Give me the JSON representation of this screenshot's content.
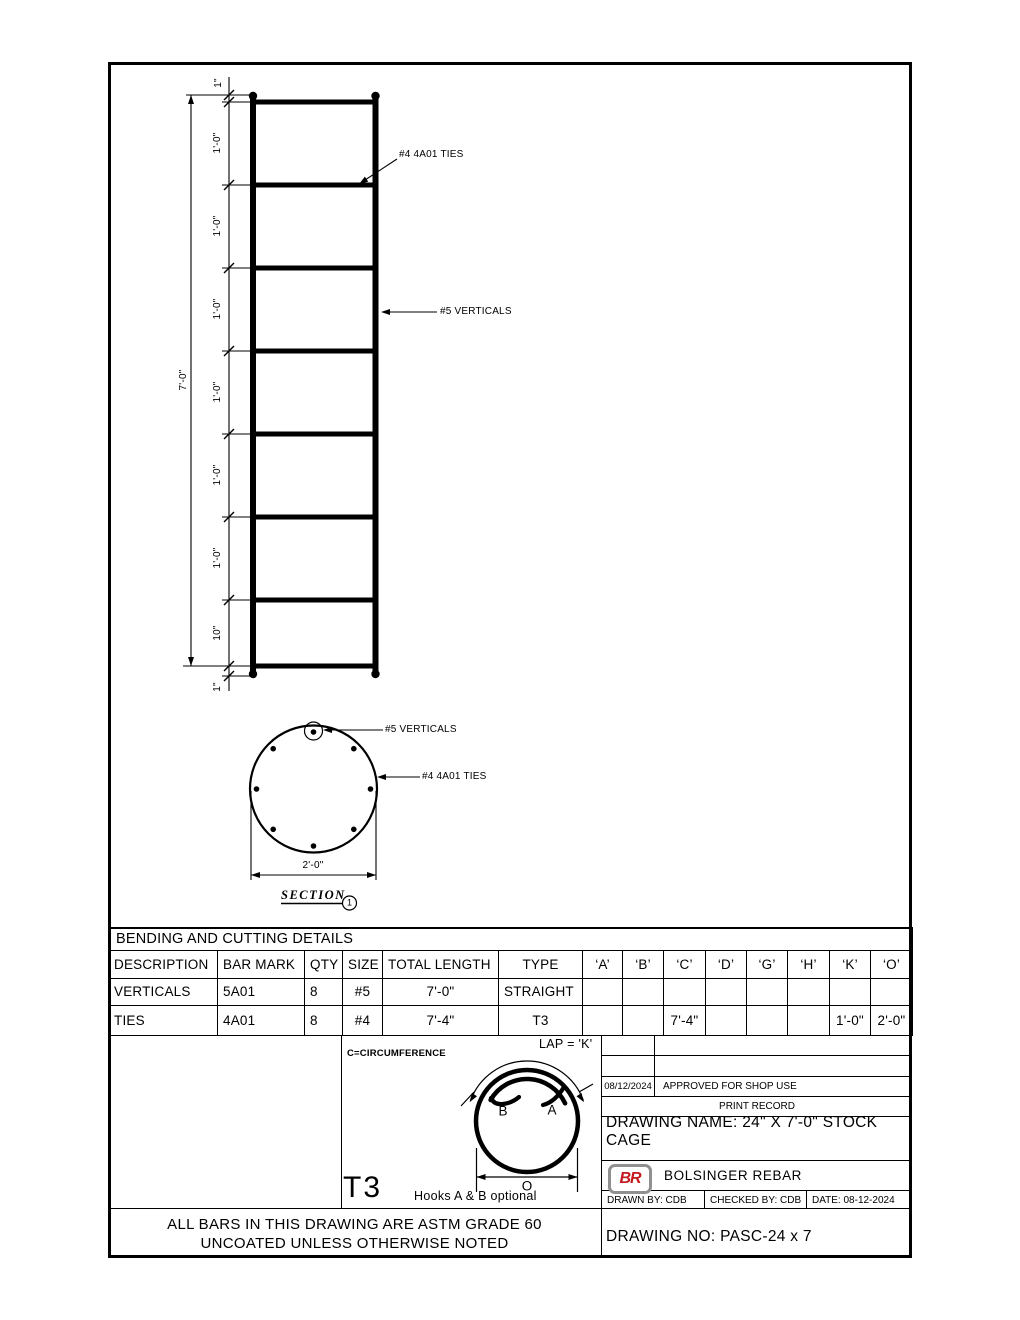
{
  "drawing": {
    "elevation": {
      "overall_dim": "7'-0\"",
      "spacings": [
        "1\"",
        "1'-0\"",
        "1'-0\"",
        "1'-0\"",
        "1'-0\"",
        "1'-0\"",
        "1'-0\"",
        "10\"",
        "1\""
      ],
      "tie_label": "#4 4A01 TIES",
      "vertical_label": "#5 VERTICALS"
    },
    "section": {
      "vertical_label": "#5 VERTICALS",
      "tie_label": "#4 4A01 TIES",
      "diameter_dim": "2'-0\"",
      "title": "SECTION",
      "balloon": "1"
    },
    "t3_detail": {
      "circumference_note": "C=CIRCUMFERENCE",
      "lap_label": "LAP = 'K'",
      "hook_b": "B",
      "hook_a": "A",
      "dim_o": "O",
      "type_label": "T3",
      "hooks_note": "Hooks A & B optional"
    }
  },
  "bending_table": {
    "title": "BENDING AND CUTTING DETAILS",
    "headers": [
      "DESCRIPTION",
      "BAR MARK",
      "QTY",
      "SIZE",
      "TOTAL LENGTH",
      "TYPE",
      "‘A’",
      "‘B’",
      "‘C’",
      "‘D’",
      "‘G’",
      "‘H’",
      "‘K’",
      "‘O’"
    ],
    "rows": [
      [
        "VERTICALS",
        "5A01",
        "8",
        "#5",
        "7'-0\"",
        "STRAIGHT",
        "",
        "",
        "",
        "",
        "",
        "",
        "",
        ""
      ],
      [
        "TIES",
        "4A01",
        "8",
        "#4",
        "7'-4\"",
        "T3",
        "",
        "",
        "7'-4\"",
        "",
        "",
        "",
        "1'-0\"",
        "2'-0\""
      ]
    ]
  },
  "title_block": {
    "print_record": {
      "date": "08/12/2024",
      "note": "APPROVED FOR SHOP USE",
      "label": "PRINT RECORD"
    },
    "drawing_name": "DRAWING NAME: 24\" X 7'-0\" STOCK CAGE",
    "logo": "BR",
    "company": "BOLSINGER REBAR",
    "drawn_by": "DRAWN BY: CDB",
    "checked_by": "CHECKED BY: CDB",
    "date": "DATE: 08-12-2024",
    "drawing_no": "DRAWING NO: PASC-24 x 7"
  },
  "notes": {
    "line1": "ALL BARS IN THIS DRAWING ARE ASTM GRADE 60",
    "line2": "UNCOATED UNLESS OTHERWISE NOTED"
  }
}
